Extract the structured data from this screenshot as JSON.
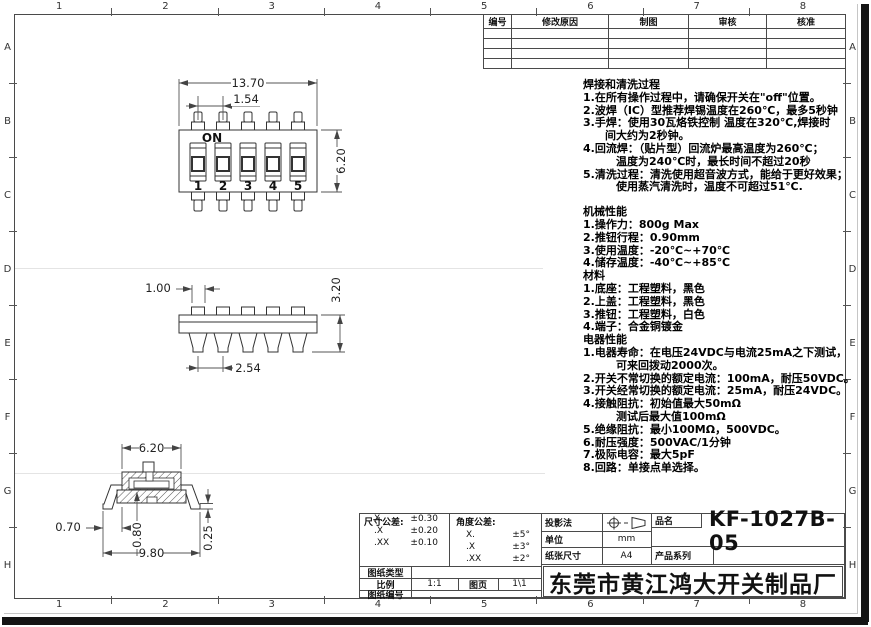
{
  "page": {
    "border_cols": [
      "1",
      "2",
      "3",
      "4",
      "5",
      "6",
      "7",
      "8"
    ],
    "border_rows": [
      "A",
      "B",
      "C",
      "D",
      "E",
      "F",
      "G",
      "H"
    ]
  },
  "revision_table": {
    "headers": [
      "编号",
      "修改原因",
      "制图",
      "审核",
      "核准"
    ]
  },
  "views": {
    "top_view": {
      "on_label": "ON",
      "positions": [
        "1",
        "2",
        "3",
        "4",
        "5"
      ],
      "dims": {
        "width": "13.70",
        "pitch": "1.54",
        "height": "6.20"
      }
    },
    "front_view": {
      "dims": {
        "tab_width": "1.00",
        "height": "3.20",
        "pitch": "2.54"
      }
    },
    "section_view": {
      "dims": {
        "body_width": "6.20",
        "foot_offset": "0.70",
        "inner_height": "0.80",
        "foot_thickness": "0.25",
        "total_width": "9.80"
      }
    }
  },
  "notes": {
    "soldering": {
      "title": "焊接和清洗过程",
      "lines": [
        "1.在所有操作过程中，请确保开关在\"off\"位置。",
        "2.波焊（IC）型推荐焊锡温度在260℃，最多5秒钟",
        "3.手焊：使用30瓦烙铁控制 温度在320℃,焊接时",
        "　　间大约为2秒钟。",
        "4.回流焊：（贴片型）回流炉最高温度为260℃；",
        "　　　温度为240℃时，最长时间不超过20秒",
        "5.清洗过程：清洗使用超音波方式，能给于更好效果；",
        "　　　使用蒸汽清洗时，温度不可超过51℃."
      ]
    },
    "mechanical": {
      "title": "机械性能",
      "lines": [
        "1.操作力：800g Max",
        "2.推钮行程：0.90mm",
        "3.使用温度：-20℃~+70℃",
        "4.储存温度：-40℃~+85℃"
      ]
    },
    "material": {
      "title": "材料",
      "lines": [
        "1.底座：工程塑料，黑色",
        "2.上盖：工程塑料，黑色",
        "3.推钮：工程塑料，白色",
        "4.端子：合金铜镀金"
      ]
    },
    "electrical": {
      "title": "电器性能",
      "lines": [
        "1.电器寿命：在电压24VDC与电流25mA之下测试，",
        "　　　可来回拨动2000次。",
        "2.开关不常切换的额定电流：100mA，耐压50VDC。",
        "3.开关经常切换的额定电流：25mA，耐压24VDC。",
        "4.接触阻抗：初始值最大50mΩ",
        "　　　测试后最大值100mΩ",
        "5.绝缘阻抗：最小100MΩ，500VDC。",
        "6.耐压强度：500VAC/1分钟",
        "7.极际电容：最大5pF",
        "8.回路：单接点单选择。"
      ]
    }
  },
  "title_block": {
    "dim_tolerance": {
      "title": "尺寸公差:",
      "rows": [
        [
          "X.",
          "±0.30"
        ],
        [
          ".X",
          "±0.20"
        ],
        [
          ".XX",
          "±0.10"
        ]
      ]
    },
    "angle_tolerance": {
      "title": "角度公差:",
      "rows": [
        [
          "X.",
          "±5°"
        ],
        [
          ".X",
          "±3°"
        ],
        [
          ".XX",
          "±2°"
        ]
      ]
    },
    "drawing_type_label": "图纸类型",
    "scale_label": "比例",
    "scale_value": "1:1",
    "sheet_label": "图页",
    "sheet_value": "1\\1",
    "drawing_no_label": "图纸编号",
    "projection_label": "投影法",
    "unit_label": "单位",
    "unit_value": "mm",
    "paper_label": "纸张尺寸",
    "paper_value": "A4",
    "product_name_label": "品名",
    "product_name": "KF-1027B-05",
    "product_series_label": "产品系列",
    "company": "东莞市黄江鸿大开关制品厂"
  }
}
